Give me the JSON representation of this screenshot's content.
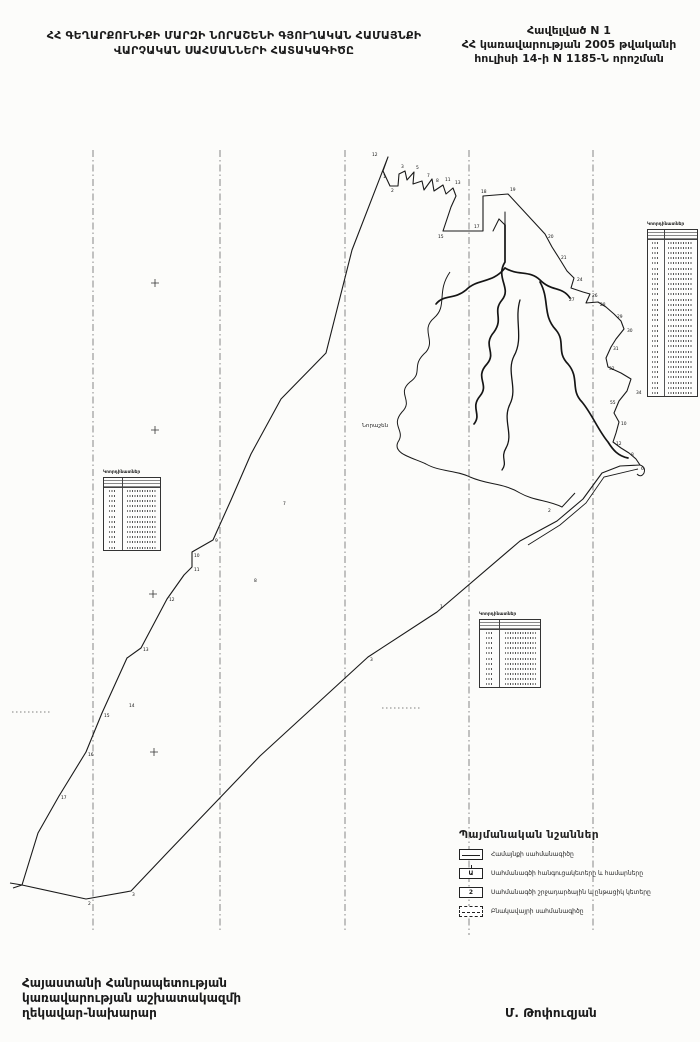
{
  "header": {
    "title_line1": "ՀՀ ԳԵՂԱՐՔՈՒՆԻՔԻ ՄԱՐԶԻ ՆՈՐԱՇԵՆԻ ԳՅՈՒՂԱԿԱՆ ՀԱՄԱՅՆՔԻ",
    "title_line2": "ՎԱՐՉԱԿԱՆ ՍԱՀՄԱՆՆԵՐԻ ՀԱՏԱԿԱԳԻԾԸ",
    "annex_line1": "Հավելված N 1",
    "annex_line2": "ՀՀ կառավարության 2005 թվականի",
    "annex_line3": "հուլիսի 14-ի N 1185-Ն որոշման"
  },
  "map": {
    "center_label": "Նորաշեն",
    "point_labels": [
      {
        "x": 372,
        "y": 156,
        "n": "12"
      },
      {
        "x": 383,
        "y": 178,
        "n": "1"
      },
      {
        "x": 391,
        "y": 192,
        "n": "2"
      },
      {
        "x": 401,
        "y": 168,
        "n": "3"
      },
      {
        "x": 416,
        "y": 169,
        "n": "5"
      },
      {
        "x": 427,
        "y": 177,
        "n": "7"
      },
      {
        "x": 436,
        "y": 182,
        "n": "8"
      },
      {
        "x": 445,
        "y": 181,
        "n": "11"
      },
      {
        "x": 455,
        "y": 184,
        "n": "13"
      },
      {
        "x": 438,
        "y": 238,
        "n": "15"
      },
      {
        "x": 474,
        "y": 228,
        "n": "17"
      },
      {
        "x": 481,
        "y": 193,
        "n": "18"
      },
      {
        "x": 510,
        "y": 191,
        "n": "19"
      },
      {
        "x": 548,
        "y": 238,
        "n": "20"
      },
      {
        "x": 561,
        "y": 259,
        "n": "21"
      },
      {
        "x": 577,
        "y": 281,
        "n": "24"
      },
      {
        "x": 592,
        "y": 297,
        "n": "26"
      },
      {
        "x": 569,
        "y": 301,
        "n": "27"
      },
      {
        "x": 600,
        "y": 306,
        "n": "28"
      },
      {
        "x": 617,
        "y": 318,
        "n": "29"
      },
      {
        "x": 627,
        "y": 332,
        "n": "30"
      },
      {
        "x": 613,
        "y": 350,
        "n": "31"
      },
      {
        "x": 609,
        "y": 370,
        "n": "32"
      },
      {
        "x": 636,
        "y": 394,
        "n": "34"
      },
      {
        "x": 610,
        "y": 404,
        "n": "55"
      },
      {
        "x": 621,
        "y": 425,
        "n": "10"
      },
      {
        "x": 616,
        "y": 445,
        "n": "12"
      },
      {
        "x": 631,
        "y": 456,
        "n": "8"
      },
      {
        "x": 641,
        "y": 470,
        "n": "6"
      },
      {
        "x": 548,
        "y": 512,
        "n": "2"
      },
      {
        "x": 440,
        "y": 608,
        "n": "1"
      },
      {
        "x": 370,
        "y": 661,
        "n": "3"
      },
      {
        "x": 283,
        "y": 505,
        "n": "7"
      },
      {
        "x": 254,
        "y": 582,
        "n": "8"
      },
      {
        "x": 215,
        "y": 542,
        "n": "9"
      },
      {
        "x": 194,
        "y": 557,
        "n": "10"
      },
      {
        "x": 194,
        "y": 571,
        "n": "11"
      },
      {
        "x": 169,
        "y": 601,
        "n": "12"
      },
      {
        "x": 143,
        "y": 651,
        "n": "13"
      },
      {
        "x": 129,
        "y": 707,
        "n": "14"
      },
      {
        "x": 104,
        "y": 717,
        "n": "15"
      },
      {
        "x": 88,
        "y": 756,
        "n": "16"
      },
      {
        "x": 61,
        "y": 799,
        "n": "17"
      },
      {
        "x": 88,
        "y": 905,
        "n": "2"
      },
      {
        "x": 132,
        "y": 896,
        "n": "3"
      }
    ]
  },
  "tables": [
    {
      "title": "Կոորդինատներ",
      "row_count": 12
    },
    {
      "title": "Կոորդինատներ",
      "row_count": 11
    },
    {
      "title": "Կոորդինատներ",
      "row_count": 30
    }
  ],
  "legend": {
    "title": "Պայմանական նշաններ",
    "items": [
      {
        "symbol": "line",
        "glyph": "",
        "label": "Համայնքի սահմանագիծը"
      },
      {
        "symbol": "node",
        "glyph": "Ա",
        "label": "Սահմանագծի հանգուցակետերը և համարները"
      },
      {
        "symbol": "turn",
        "glyph": "2",
        "label": "Սահմանագծի շրջադարձային և ընթացիկ կետերը"
      },
      {
        "symbol": "dashed",
        "glyph": "",
        "label": "Բնակավայրի սահմանագիծը"
      }
    ]
  },
  "footer": {
    "left_line1": "Հայաստանի Հանրապետության",
    "left_line2": "կառավարության աշխատակազմի",
    "left_line3": "ղեկավար-նախարար",
    "right_signature": "Մ. Թոփուզյան"
  }
}
